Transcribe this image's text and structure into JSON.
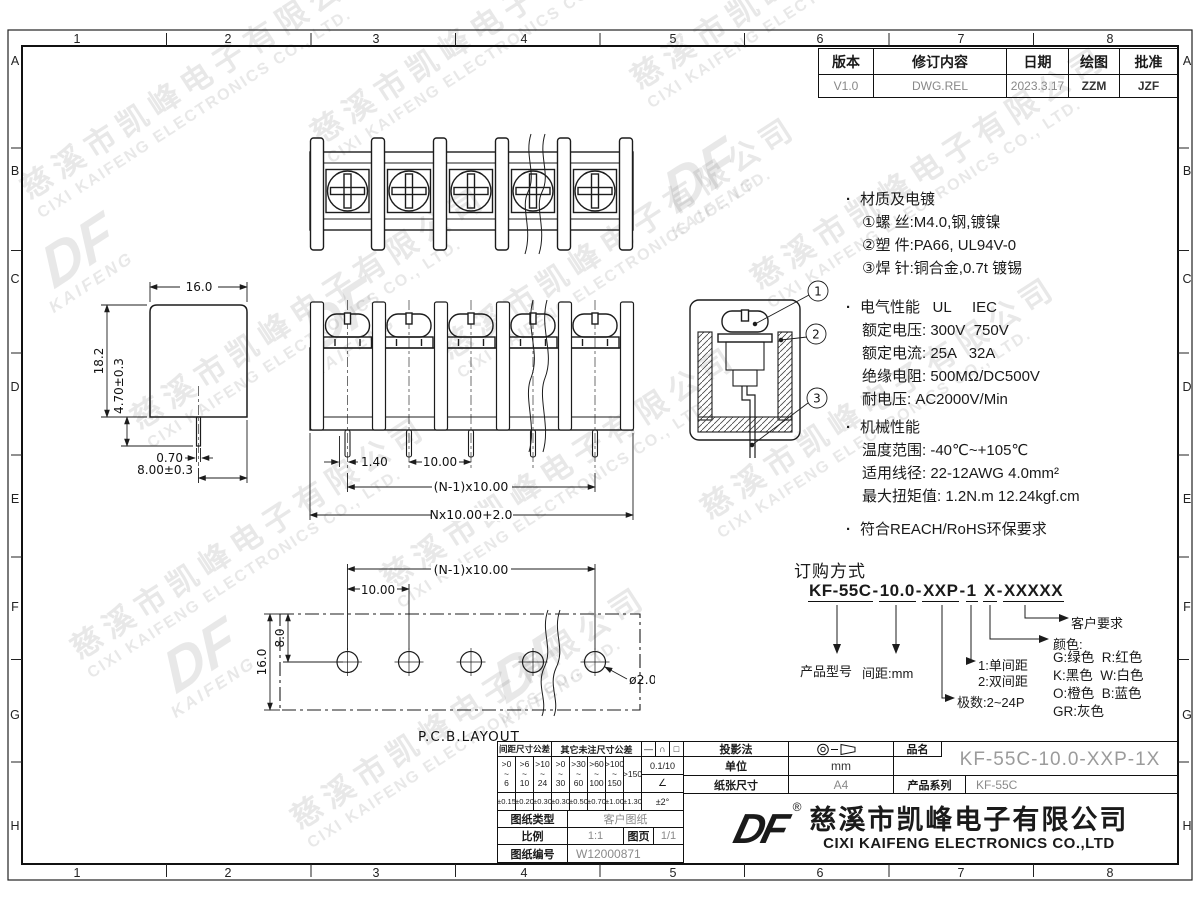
{
  "grid": {
    "cols": [
      "1",
      "2",
      "3",
      "4",
      "5",
      "6",
      "7",
      "8"
    ],
    "rows": [
      "A",
      "B",
      "C",
      "D",
      "E",
      "F",
      "G",
      "H"
    ]
  },
  "watermark": {
    "cn": "慈溪市凯峰电子有限公司",
    "en": "CIXI KAIFENG ELECTRONICS CO., LTD.",
    "logo": "DF",
    "logo_sub": "KAIFENG"
  },
  "revision": {
    "headers": [
      "版本",
      "修订内容",
      "日期",
      "绘图",
      "批准"
    ],
    "row": [
      "V1.0",
      "DWG.REL",
      "2023.3.17",
      "ZZM",
      "JZF"
    ]
  },
  "notes": {
    "bullet": "·",
    "material": {
      "title": "材质及电镀",
      "items": [
        "①螺 丝:M4.0,钢,镀镍",
        "②塑 件:PA66, UL94V-0",
        "③焊 针:铜合金,0.7t 镀锡"
      ]
    },
    "electrical": {
      "title": "电气性能   UL     IEC",
      "items": [
        "额定电压: 300V  750V",
        "额定电流: 25A   32A",
        "绝缘电阻: 500MΩ/DC500V",
        "耐电压: AC2000V/Min"
      ]
    },
    "mechanical": {
      "title": "机械性能",
      "items": [
        "温度范围: -40℃~+105℃",
        "适用线径: 22-12AWG 4.0mm²",
        "最大扭矩值: 1.2N.m 12.24kgf.cm"
      ]
    },
    "compliance": "符合REACH/RoHS环保要求"
  },
  "ordering": {
    "title": "订购方式",
    "segments": [
      "KF-55C",
      "10.0",
      "XXP",
      "1",
      "X",
      "XXXXX"
    ],
    "separators": [
      "-",
      "-",
      "-",
      " ",
      "-"
    ],
    "labels": {
      "model": "产品型号",
      "pitch": "间距:mm",
      "poles": "极数:2~24P",
      "single": "1:单间距",
      "double": "2:双间距",
      "customer": "客户要求",
      "color_title": "颜色:",
      "colors": [
        "G:绿色  R:红色",
        "K:黑色  W:白色",
        "O:橙色  B:蓝色",
        "GR:灰色"
      ]
    }
  },
  "dims": {
    "side": {
      "width": "16.0",
      "height": "18.2",
      "pin_len": "4.70±0.3",
      "pin_w": "0.70",
      "pin_off": "8.00±0.3"
    },
    "front": {
      "offset": "1.40",
      "pitch": "10.00",
      "span": "(N-1)x10.00",
      "total": "Nx10.00+2.0"
    },
    "pcb": {
      "label": "P.C.B.LAYOUT",
      "span": "(N-1)x10.00",
      "pitch": "10.00",
      "row": "8.0",
      "depth": "16.0",
      "hole": "ø2.0"
    },
    "section": {
      "c1": "1",
      "c2": "2",
      "c3": "3"
    }
  },
  "title_block": {
    "tol": {
      "pitch_header": "间距尺寸公差",
      "other_header": "其它未注尺寸公差",
      "sym1": "—",
      "sym2": "∩",
      "sym3": "□",
      "ranges": [
        ">0\n~\n6",
        ">6\n~\n10",
        ">10\n~\n24",
        ">0\n~\n30",
        ">30\n~\n60",
        ">60\n~\n100",
        ">100\n~\n150",
        ">150"
      ],
      "flatness": "0.1/10",
      "angle_sym": "∠",
      "tols": [
        "±0.15",
        "±0.20",
        "±0.30",
        "±0.30",
        "±0.50",
        "±0.70",
        "±1.00",
        "±1.30"
      ],
      "angle_tol": "±2°"
    },
    "type_label": "图纸类型",
    "type_value": "客户图纸",
    "scale_label": "比例",
    "scale_value": "1:1",
    "page_label": "图页",
    "page_value": "1/1",
    "number_label": "图纸编号",
    "number_value": "W12000871",
    "projection_label": "投影法",
    "unit_label": "单位",
    "unit_value": "mm",
    "paper_label": "纸张尺寸",
    "paper_value": "A4",
    "name_label": "品名",
    "name_value": "KF-55C-10.0-XXP-1X",
    "series_label": "产品系列",
    "series_value": "KF-55C"
  },
  "company": {
    "logo": "DF",
    "reg": "®",
    "name_cn": "慈溪市凯峰电子有限公司",
    "name_en": "CIXI KAIFENG ELECTRONICS CO.,LTD"
  }
}
